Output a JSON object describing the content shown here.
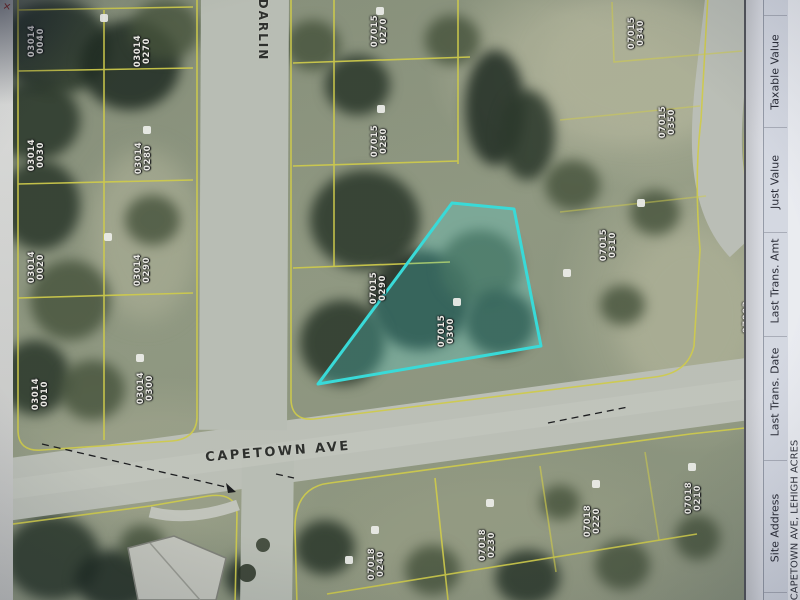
{
  "map": {
    "streets": [
      {
        "name": "CAPETOWN AVE"
      },
      {
        "name": "DARLIN"
      }
    ],
    "highlight_color": "#3ae3de",
    "parcel_line_color": "#d8d34a",
    "highlighted_parcel": {
      "block": "07015",
      "lot": "0300"
    },
    "parcels": [
      {
        "block": "03014",
        "lot": "0040",
        "cx": 37,
        "cy": 41
      },
      {
        "block": "03014",
        "lot": "0270",
        "cx": 143,
        "cy": 51
      },
      {
        "block": "03014",
        "lot": "0030",
        "cx": 37,
        "cy": 155
      },
      {
        "block": "03014",
        "lot": "0280",
        "cx": 144,
        "cy": 158
      },
      {
        "block": "03014",
        "lot": "0020",
        "cx": 37,
        "cy": 267
      },
      {
        "block": "03014",
        "lot": "0290",
        "cx": 143,
        "cy": 270
      },
      {
        "block": "03014",
        "lot": "0010",
        "cx": 41,
        "cy": 394
      },
      {
        "block": "03014",
        "lot": "0300",
        "cx": 146,
        "cy": 388
      },
      {
        "block": "07015",
        "lot": "0270",
        "cx": 380,
        "cy": 31
      },
      {
        "block": "07015",
        "lot": "0280",
        "cx": 380,
        "cy": 141
      },
      {
        "block": "07015",
        "lot": "0290",
        "cx": 379,
        "cy": 288
      },
      {
        "block": "07015",
        "lot": "0300",
        "cx": 447,
        "cy": 331,
        "highlight": true
      },
      {
        "block": "07015",
        "lot": "0310",
        "cx": 609,
        "cy": 245
      },
      {
        "block": "07015",
        "lot": "0340",
        "cx": 637,
        "cy": 33
      },
      {
        "block": "07015",
        "lot": "0350",
        "cx": 668,
        "cy": 122
      },
      {
        "block": "07018",
        "lot": "0240",
        "cx": 377,
        "cy": 564
      },
      {
        "block": "07018",
        "lot": "0230",
        "cx": 488,
        "cy": 545
      },
      {
        "block": "07018",
        "lot": "0220",
        "cx": 593,
        "cy": 521
      },
      {
        "block": "07018",
        "lot": "0210",
        "cx": 694,
        "cy": 498
      },
      {
        "block": "07003",
        "lot": "0010",
        "cx": 752,
        "cy": 317
      }
    ]
  },
  "icons": {
    "red_marker": "✕"
  },
  "table": {
    "headers": [
      "Site Address",
      "Last Trans. Date",
      "Last Trans. Amt",
      "Just Value",
      "Taxable Value"
    ],
    "row": {
      "site_address": "CAPETOWN AVE, LEHIGH ACRES"
    }
  }
}
